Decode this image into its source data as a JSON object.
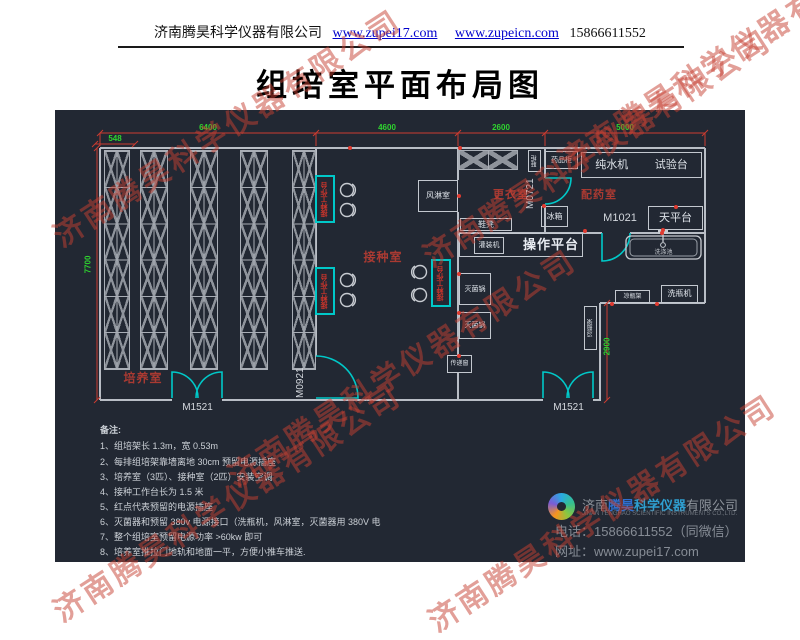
{
  "header": {
    "company": "济南腾昊科学仪器有限公司",
    "link1": "www.zupei17.com",
    "link2": "www.zupeicn.com",
    "phone": "15866611552"
  },
  "title": "组培室平面布局图",
  "watermark": {
    "text": "济南腾昊科学仪器有限公司"
  },
  "colors": {
    "cad_background": "#222833",
    "cad_dimension_green": "#2fd42f",
    "cad_dimension_red": "#cc3b30",
    "cad_door_cyan": "#00c8c8",
    "room_label_red": "#a93a32",
    "link_blue": "#0000cc",
    "watermark_red": "#c64032"
  },
  "plan": {
    "dimensions": {
      "top": [
        "548",
        "6400",
        "4600",
        "2600",
        "5000"
      ],
      "left": "7700",
      "right": "2900"
    },
    "rooms": {
      "culture": "培养室",
      "inoculation": "接种室",
      "changing": "更衣室",
      "dispensing": "配药室",
      "air_shower": "风淋室"
    },
    "doors": {
      "m1521_left": "M1521",
      "m0921": "M0921",
      "m0721": "M0721",
      "m1021": "M1021",
      "m1521_right": "M1521"
    },
    "equipment": {
      "shoe_cabinet": "鞋柜",
      "medicine_cabinet": "药品柜",
      "water_machine": "纯水机",
      "test_bench": "试验台",
      "fridge": "冰箱",
      "balance_table": "天平台",
      "sink": "洗涤池",
      "shoe_bench": "鞋凳",
      "filling_machine": "灌装机",
      "operation_platform": "操作平台",
      "sterilizer": "灭菌锅",
      "pass_window": "传递窗",
      "bottle_cooling_rack": "凉瓶架",
      "bottle_washer": "洗瓶机"
    },
    "workbench_label": "接种工作台"
  },
  "notes": {
    "title": "备注:",
    "items": [
      "1、组培架长 1.3m，宽 0.53m",
      "2、每排组培架靠墙离地 30cm 预留电源插座",
      "3、培养室（3匹）、接种室（2匹）安装空调",
      "4、接种工作台长为 1.5 米",
      "5、红点代表预留的电源插座",
      "6、灭菌器和预留 380v 电源接口（洗瓶机，风淋室，灭菌器用 380V 电",
      "7、整个组培室预留电源功率 >60kw 即可",
      "8、培养室推拉门地轨和地面一平，方便小推车推送."
    ]
  },
  "footer": {
    "company_cn_1": "济南",
    "company_cn_2": "腾昊",
    "company_cn_3": "科学仪器",
    "company_cn_4": "有限公司",
    "company_en": "JINAN TENGHAO SCIENTIFIC INSTRUMENTS CO.,LTD.",
    "phone_line": "电话：15866611552（同微信）",
    "site_line": "网址：www.zupei17.com"
  }
}
